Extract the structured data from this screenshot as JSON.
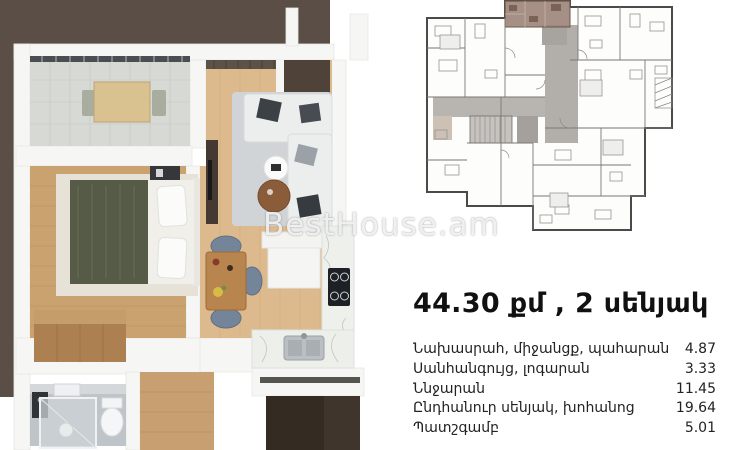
{
  "watermark": {
    "text": "BestHouse.am"
  },
  "listing": {
    "title": "44.30 քմ , 2 սենյակ",
    "areas": [
      {
        "label": "Նախասրահ, միջանցք, պահարան",
        "value": "4.87"
      },
      {
        "label": "Սանհանգույց, լոգարան",
        "value": "3.33"
      },
      {
        "label": "Ննջարան",
        "value": "11.45"
      },
      {
        "label": "Ընդհանուր սենյակ, խոհանոց",
        "value": "19.64"
      },
      {
        "label": "Պատշգամբ",
        "value": "5.01"
      }
    ]
  },
  "colors": {
    "backdrop": "#5a4e47",
    "living_floor": "#ddba8e",
    "bedroom_floor": "#c9a26f",
    "balcony_tile": "#d6d9d4",
    "bath_floor": "#bfc4c8",
    "highlighted_unit": "#9c8478",
    "text": "#1a1a1a"
  }
}
